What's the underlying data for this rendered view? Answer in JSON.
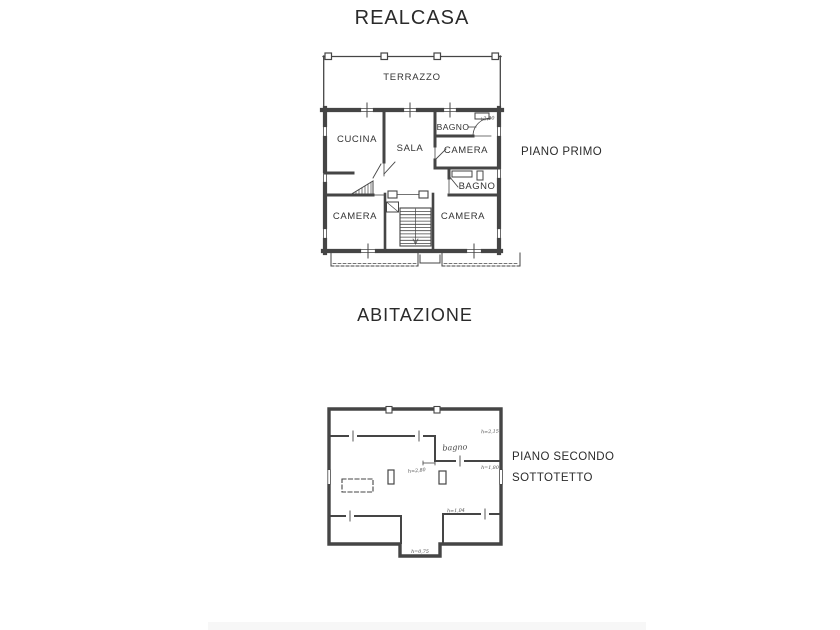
{
  "header": {
    "title": "REALCASA"
  },
  "section": {
    "label": "ABITAZIONE"
  },
  "piano_primo": {
    "label": "PIANO PRIMO",
    "rooms": {
      "terrazzo": "TERRAZZO",
      "cucina": "CUCINA",
      "sala": "SALA",
      "bagno_top": "BAGNO",
      "camera_top_right": "CAMERA",
      "bagno_mid": "BAGNO",
      "camera_bottom_left": "CAMERA",
      "camera_bottom_right": "CAMERA"
    },
    "handwritten_note": "+2,40"
  },
  "piano_secondo": {
    "label_line1": "PIANO SECONDO",
    "label_line2": "SOTTOTETTO",
    "rooms": {
      "bagno": "bagno"
    },
    "height_notes": {
      "top_right": "h=2,15",
      "mid_right": "h=1,80",
      "center": "h=2,80",
      "lower_right": "h=1,04",
      "bottom": "h=0,75"
    }
  },
  "colors": {
    "ink": "#454545",
    "paper": "#ffffff",
    "scan_strip": "#f7f7f7"
  }
}
